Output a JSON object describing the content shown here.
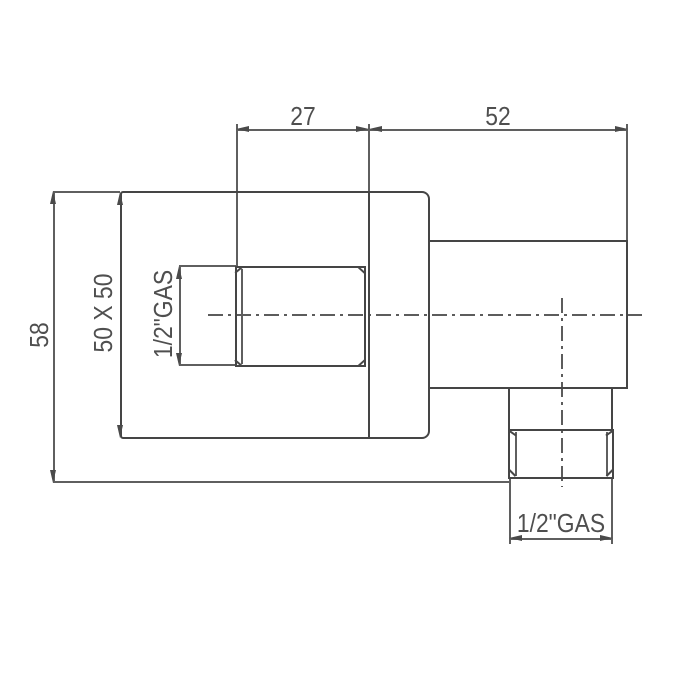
{
  "drawing": {
    "type": "technical-dimension-drawing",
    "part": "wall-elbow-fitting",
    "line_color": "#454545",
    "dim_color": "#5f5f5f",
    "text_color": "#4f4f4f",
    "background": "#ffffff",
    "dimensions": {
      "boss_length": "27",
      "body_length": "52",
      "overall_height": "58",
      "plate_size": "50 X 50",
      "inlet_thread": "1/2\"GAS",
      "outlet_thread": "1/2\"GAS"
    }
  }
}
